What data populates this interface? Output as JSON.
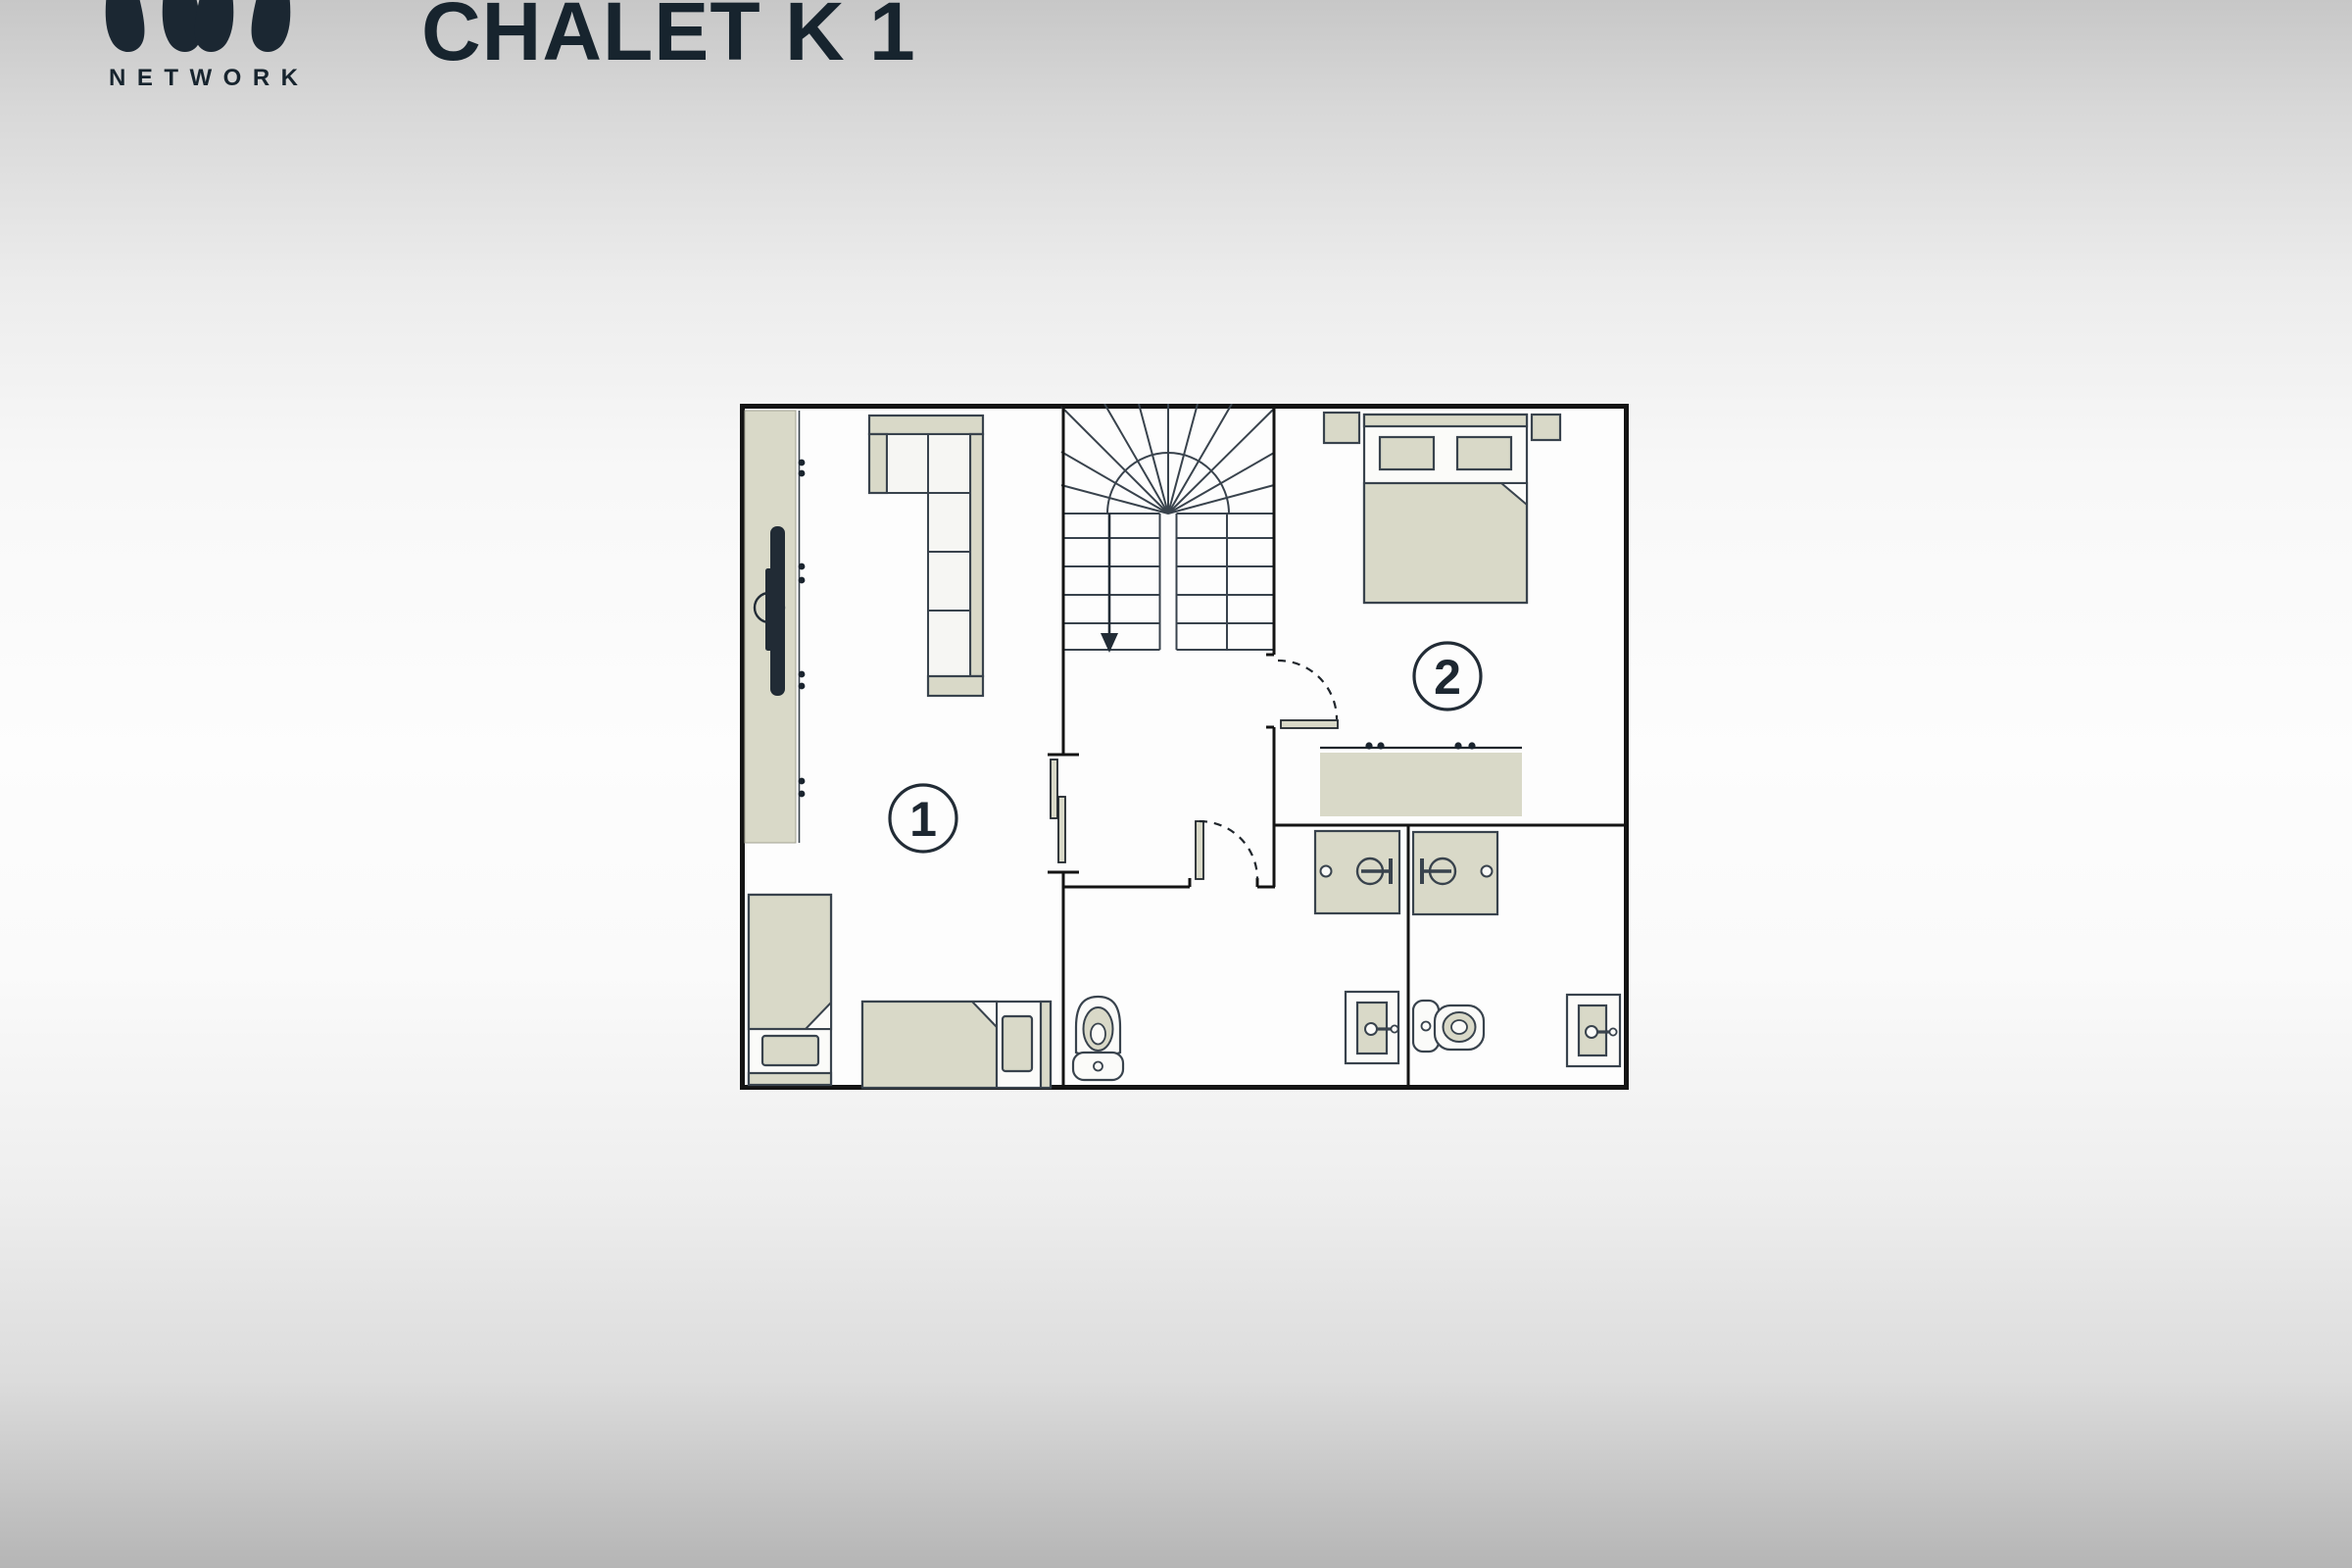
{
  "header": {
    "logo_caption": "NETWORK",
    "title": "CHALET K 1"
  },
  "plan": {
    "rooms": [
      {
        "label": "1",
        "name": "living-room",
        "furniture": [
          "media-wall",
          "wall-tv",
          "corner-sofa",
          "single-bed",
          "single-bed"
        ]
      },
      {
        "label": "2",
        "name": "bedroom",
        "furniture": [
          "double-bed",
          "nightstand",
          "nightstand",
          "double-sink-vanity"
        ]
      }
    ],
    "stairs": {
      "type": "winder-switchback",
      "direction_arrow": "down"
    },
    "bathrooms": [
      {
        "fixtures": [
          "shower",
          "toilet",
          "washbasin"
        ]
      },
      {
        "fixtures": [
          "shower",
          "toilet",
          "washbasin"
        ]
      }
    ],
    "doors": [
      "sliding-double-door",
      "swing-door-bedroom-2",
      "swing-door-bathroom-1"
    ]
  },
  "colors": {
    "beige": "#d9d9c8",
    "outline": "#39434d",
    "wall": "#141414",
    "ink": "#17242e",
    "label_ink": "#1d2731",
    "paper": "#fdfdfd"
  }
}
